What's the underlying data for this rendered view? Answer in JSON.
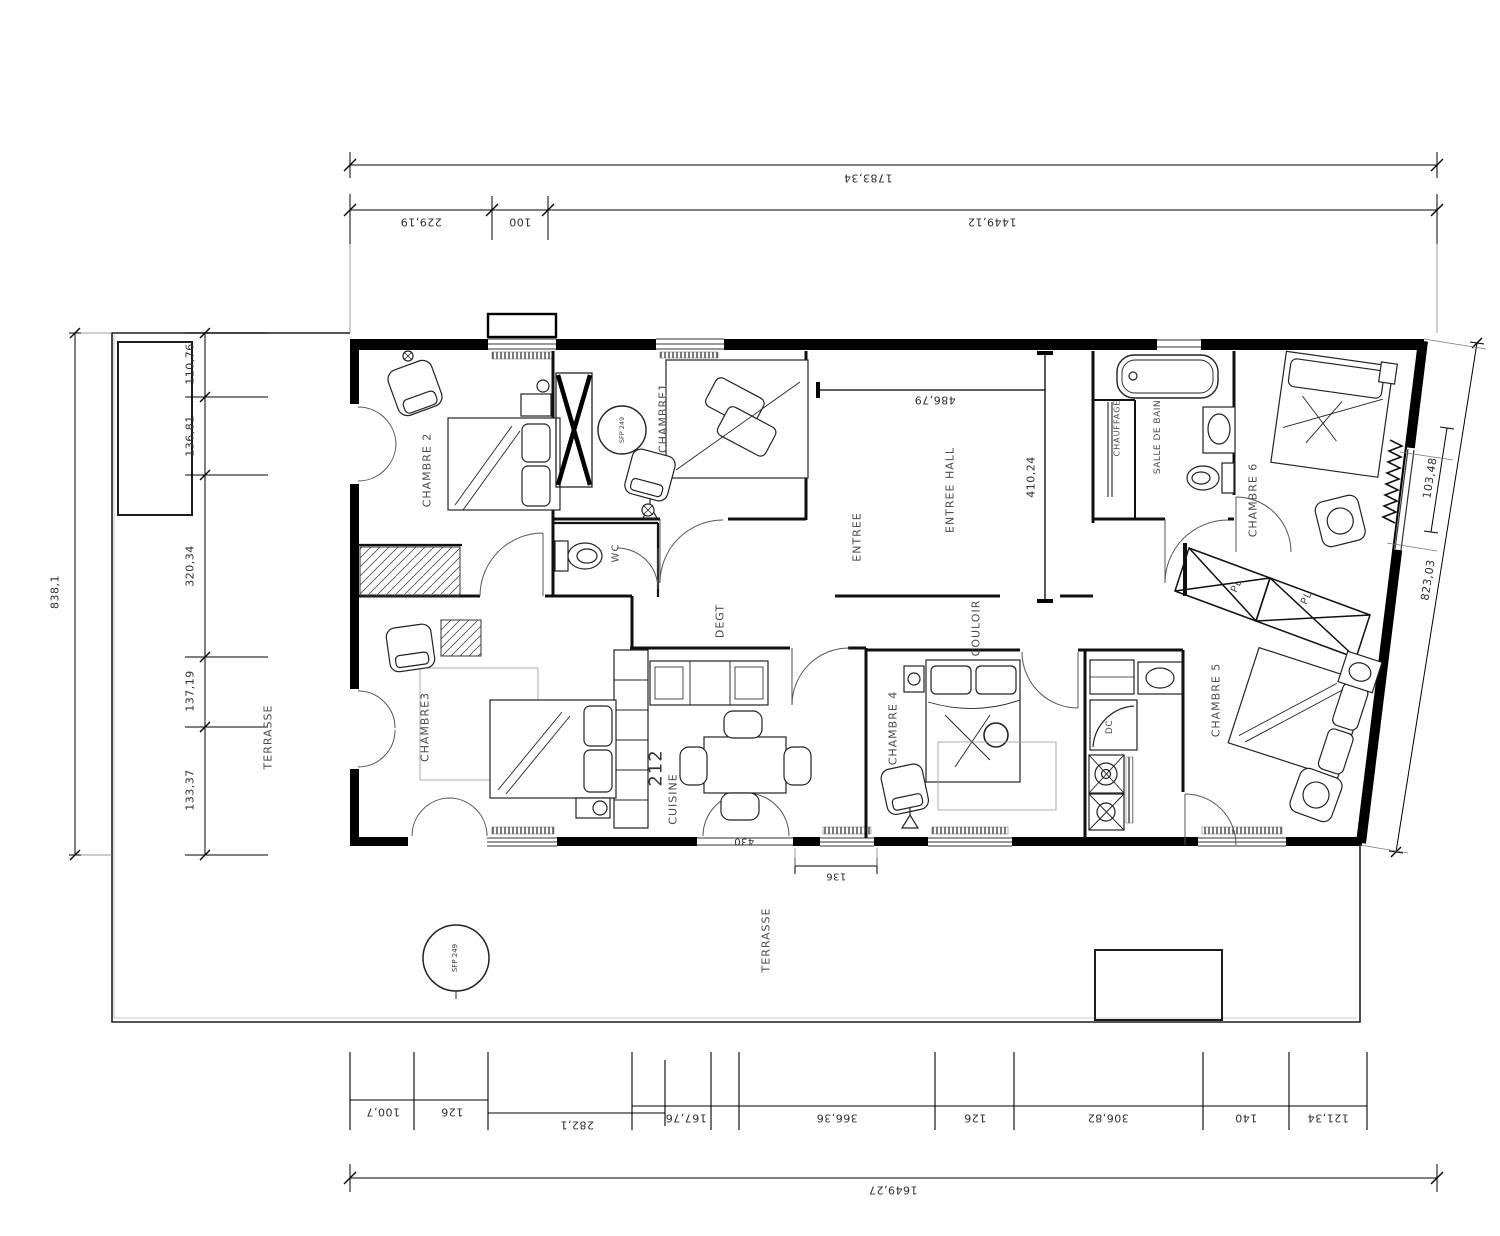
{
  "rooms": {
    "chambre1": "CHAMBRE1",
    "chambre2": "CHAMBRE 2",
    "chambre3": "CHAMBRE3",
    "chambre4": "CHAMBRE 4",
    "chambre5": "CHAMBRE 5",
    "chambre6": "CHAMBRE 6",
    "entree": "ENTREE",
    "entree_hall": "ENTREE HALL",
    "couloir": "COULOIR",
    "degt": "DEGT",
    "wc": "WC",
    "salle_de_bain": "SALLE DE BAIN",
    "chauffage": "CHAUFFAGE",
    "cuisine": "CUISINE",
    "terrasse": "TERRASSE",
    "dc": "DC",
    "pl": "PL"
  },
  "equipment": {
    "sfp_label": "SFP 249"
  },
  "dims": {
    "top": {
      "overall": "1783,34",
      "segments": [
        "229,19",
        "100",
        "1449,12"
      ]
    },
    "bottom": {
      "overall": "1649,27",
      "segments": [
        "100,7",
        "126",
        "282,1",
        "167,76",
        "366,36",
        "126",
        "306,82",
        "140",
        "121,34"
      ],
      "door_width": "430",
      "offset": "136"
    },
    "left": {
      "overall": "838,1",
      "segments": [
        "110,76",
        "136,81",
        "320,34",
        "137,19",
        "133,37"
      ]
    },
    "right": {
      "overall": "823,03",
      "window": "103,48"
    },
    "interior": {
      "hall_width": "486,79",
      "hall_depth": "410,24",
      "kitchen_height": "212"
    }
  }
}
